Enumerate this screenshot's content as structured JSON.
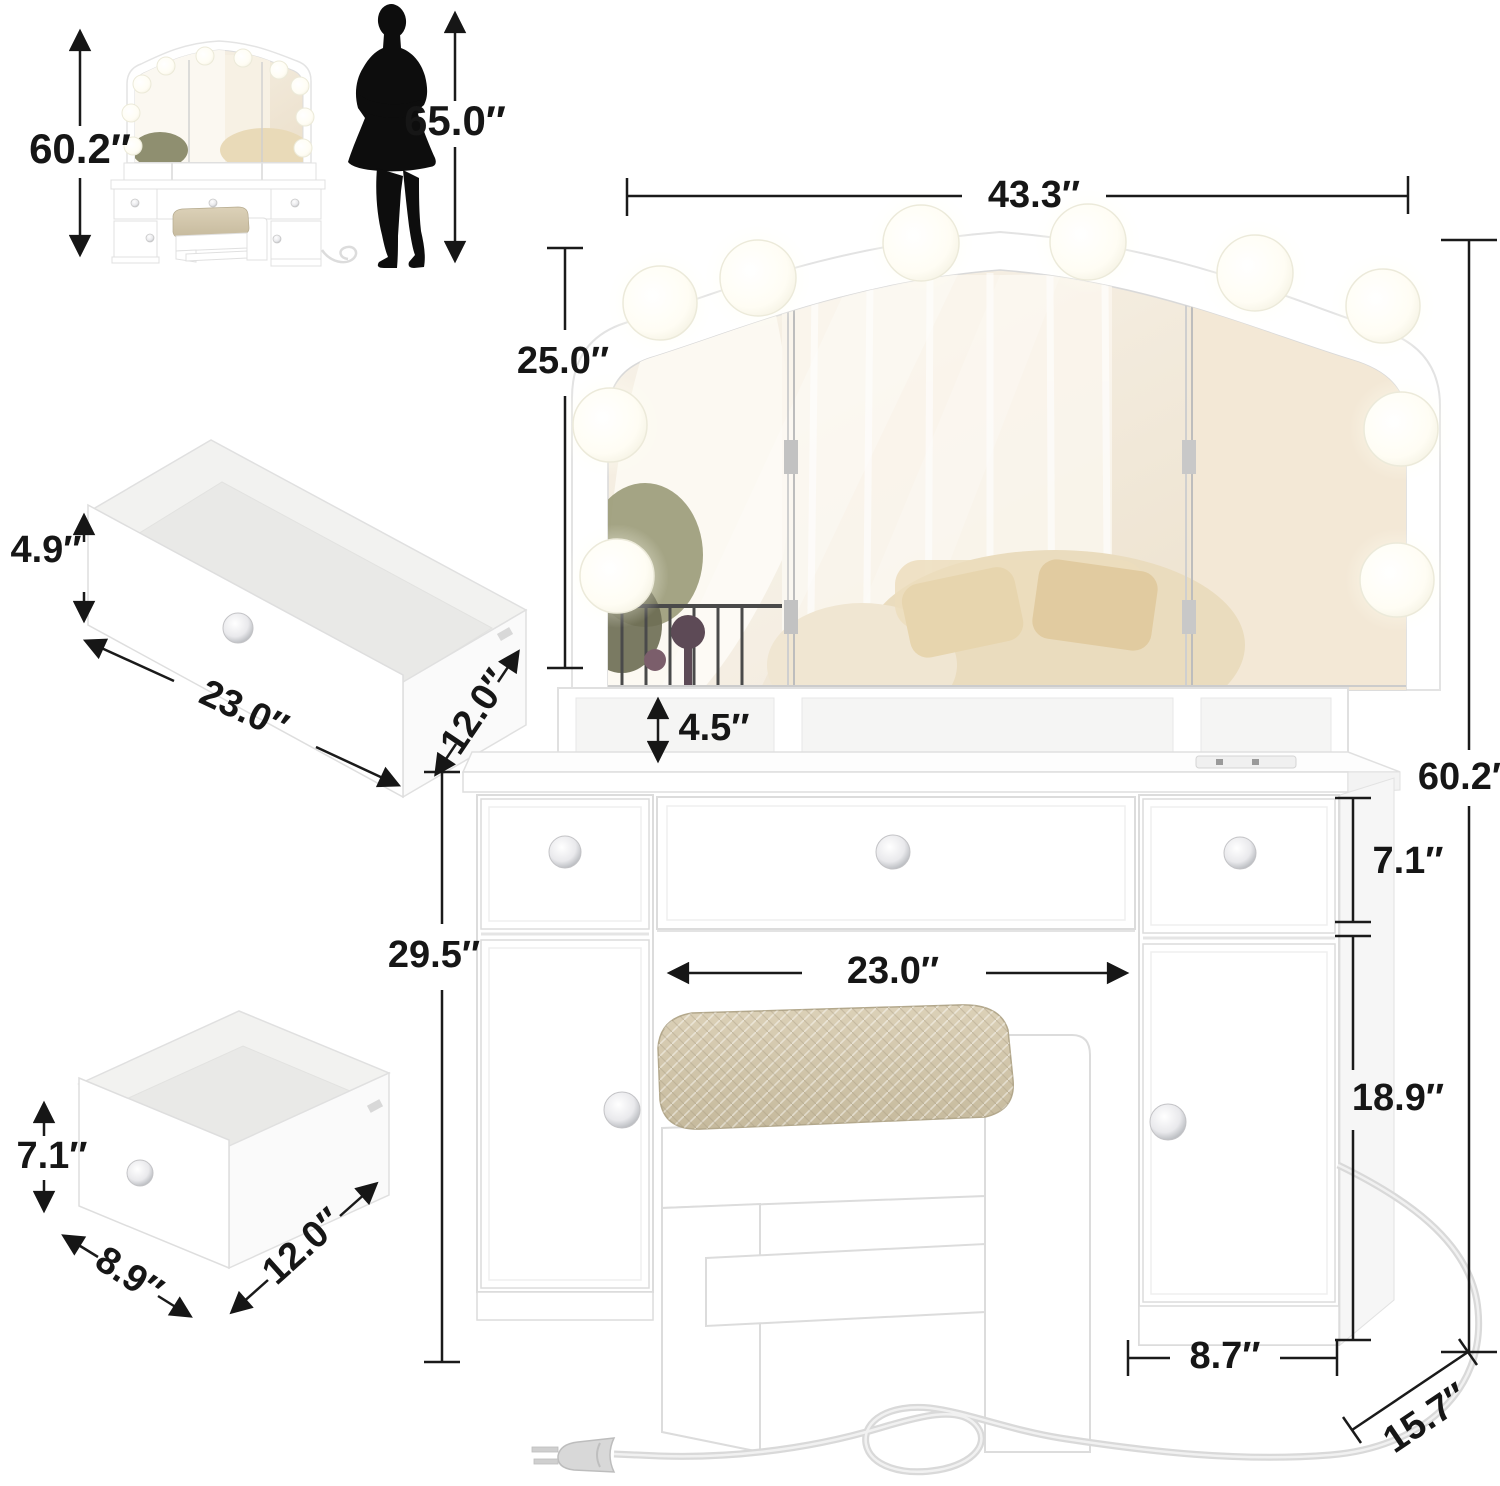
{
  "figure": {
    "type": "product-dimension-diagram",
    "description": "White vanity makeup table with lighted tri-fold mirror, five crystal-knob drawers/doors, cushioned stool, power cord, plus exploded drawer views and human height reference"
  },
  "labels": {
    "thumbnail_total_height": "60.2″",
    "person_height": "65.0″",
    "vanity_width": "43.3″",
    "mirror_height": "25.0″",
    "shelf_height": "4.5″",
    "vanity_total_height": "60.2″",
    "side_drawer_height": "7.1″",
    "legroom_width": "23.0″",
    "cabinet_door_height": "18.9″",
    "tabletop_height": "29.5″",
    "cabinet_width": "8.7″",
    "vanity_depth": "15.7″",
    "wide_drawer_height": "4.9″",
    "wide_drawer_width": "23.0″",
    "wide_drawer_depth": "12.0″",
    "small_drawer_height": "7.1″",
    "small_drawer_width": "8.9″",
    "small_drawer_depth": "12.0″"
  },
  "colors": {
    "dimension_line": "#1a1a1a",
    "furniture_outline": "#dedede",
    "furniture_fill": "#ffffff",
    "cushion": "#d3c7ab",
    "mirror_tint": "#f2e9da",
    "silhouette": "#0d0d0d",
    "cord": "#dcdcdc"
  }
}
